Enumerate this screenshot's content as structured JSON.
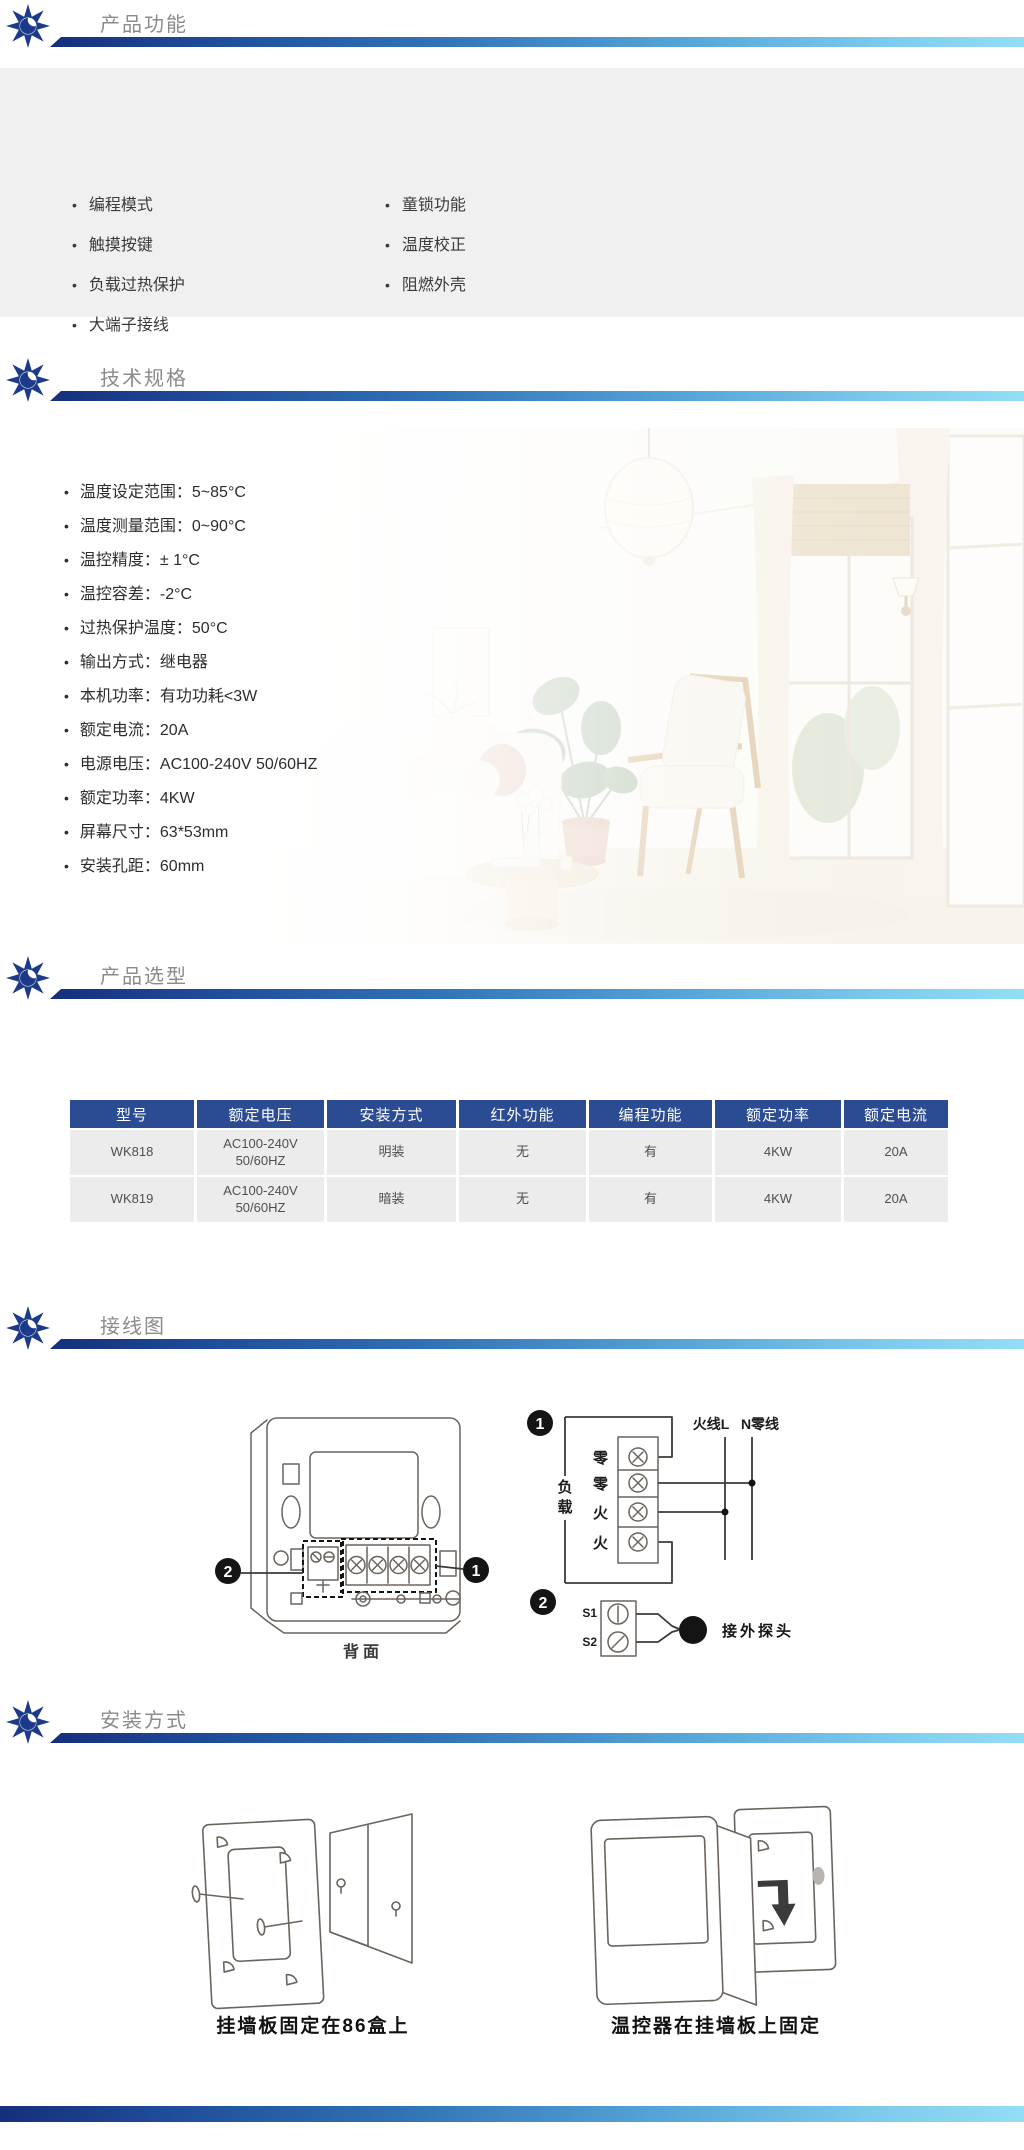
{
  "theme": {
    "bar_gradient_start": "#152f7c",
    "bar_gradient_end": "#92def6",
    "section_title_color": "#8b8b8b",
    "features_bg": "#f0f0f0",
    "table_header_bg": "#2b4b92",
    "table_row_bg": "#ececec",
    "logo_navy": "#1c3a8a"
  },
  "headers": {
    "features": "产品功能",
    "specs": "技术规格",
    "selection": "产品选型",
    "wiring": "接线图",
    "installation": "安装方式"
  },
  "features": {
    "col1": [
      "编程模式",
      "触摸按键",
      "负载过热保护",
      "大端子接线"
    ],
    "col2": [
      "童锁功能",
      "温度校正",
      "阻燃外壳"
    ]
  },
  "specs": {
    "items": [
      "温度设定范围：5~85°C",
      "温度测量范围：0~90°C",
      "温控精度：± 1°C",
      "温控容差：-2°C",
      "过热保护温度：50°C",
      "输出方式：继电器",
      "本机功率：有功功耗<3W",
      "额定电流：20A",
      "电源电压：AC100-240V 50/60HZ",
      "额定功率：4KW",
      "屏幕尺寸：63*53mm",
      "安装孔距：60mm"
    ]
  },
  "selection": {
    "headers": [
      "型号",
      "额定电压",
      "安装方式",
      "红外功能",
      "编程功能",
      "额定功率",
      "额定电流"
    ],
    "rows": [
      {
        "model": "WK818",
        "voltage1": "AC100-240V",
        "voltage2": "50/60HZ",
        "mount": "明装",
        "infrared": "无",
        "programming": "有",
        "power": "4KW",
        "current": "20A"
      },
      {
        "model": "WK819",
        "voltage1": "AC100-240V",
        "voltage2": "50/60HZ",
        "mount": "暗装",
        "infrared": "无",
        "programming": "有",
        "power": "4KW",
        "current": "20A"
      }
    ]
  },
  "wiring": {
    "badge_1": "1",
    "badge_2": "2",
    "back_caption": "背面",
    "terminals": [
      "零",
      "零",
      "火",
      "火"
    ],
    "live_label": "火线L",
    "neutral_label": "N零线",
    "load_label": "负载",
    "load_chars": [
      "负",
      "载"
    ],
    "sensor_terminals": [
      "S1",
      "S2"
    ],
    "probe_label": "接外探头"
  },
  "installation": {
    "left_caption": "挂墙板固定在86盒上",
    "right_caption": "温控器在挂墙板上固定"
  }
}
